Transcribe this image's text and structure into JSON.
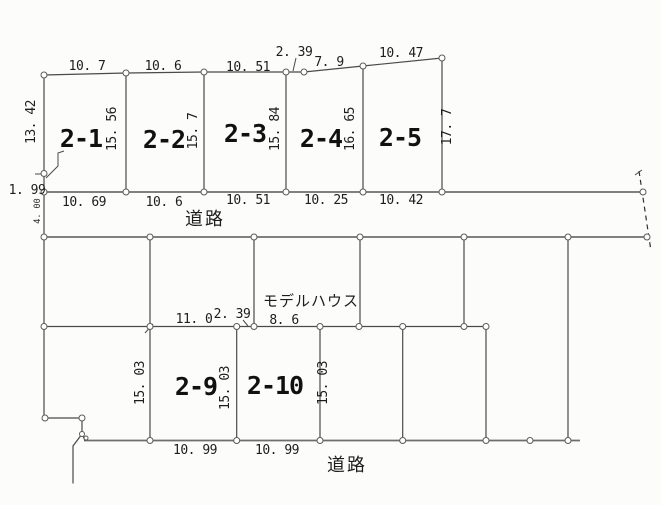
{
  "roads": {
    "top": "道路",
    "bottom": "道路"
  },
  "left_edge": {
    "upper": "13. 42",
    "lower": "1. 99",
    "road_width": "4. 00"
  },
  "top_row": {
    "plots": [
      {
        "id": "2-1"
      },
      {
        "id": "2-2"
      },
      {
        "id": "2-3"
      },
      {
        "id": "2-4"
      },
      {
        "id": "2-5"
      }
    ],
    "top_dims": [
      "10. 7",
      "10. 6",
      "10. 51",
      "2. 39",
      "7. 9",
      "10. 47"
    ],
    "depth_dims": [
      "15. 56",
      "15. 7",
      "15. 84",
      "16. 65",
      "17. 7"
    ],
    "bottom_dims": [
      "10. 69",
      "10. 6",
      "10. 51",
      "10. 25",
      "10. 42"
    ]
  },
  "middle": {
    "dims": [
      "11. 0",
      "2. 39",
      "8. 6"
    ],
    "model_house": "モデルハウス"
  },
  "bottom_row": {
    "plots": [
      {
        "id": "2-9"
      },
      {
        "id": "2-10"
      }
    ],
    "depth_dims": [
      "15. 03",
      "15. 03",
      "15. 03"
    ],
    "bottom_dims": [
      "10. 99",
      "10. 99"
    ]
  }
}
